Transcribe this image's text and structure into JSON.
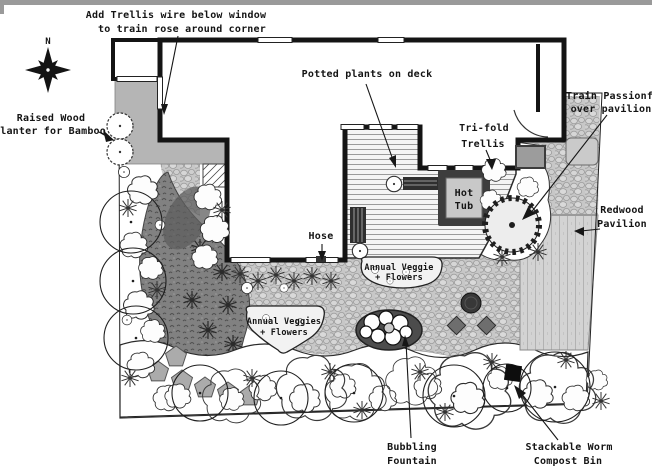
{
  "title": "Backyard landscape design plan",
  "compass": {
    "north": "N"
  },
  "colors": {
    "wall": "#141414",
    "patio_cobble": "#c7c7c7",
    "side_path": "#b5b5b5",
    "lawn_swath": "#818181",
    "pavilion": "#d3d3d3",
    "hot_tub_frame": "#3d3d3d",
    "hot_tub_inner": "#c8c8c8",
    "text": "#141414"
  },
  "labels": {
    "add_trellis": {
      "line1": "Add Trellis wire below window",
      "line2": "to train rose around corner"
    },
    "potted_plants": {
      "line1": "Potted plants on deck"
    },
    "train_passionfruit": {
      "line1": "Train Passionfruit",
      "line2": "over pavilion"
    },
    "raised_planter": {
      "line1": "Raised Wood",
      "line2": "Planter for Bamboo"
    },
    "trifold_trellis": {
      "line1": "Tri-fold",
      "line2": "Trellis"
    },
    "hose": {
      "line1": "Hose"
    },
    "hot_tub": {
      "line1": "Hot",
      "line2": "Tub"
    },
    "redwood_pavilion": {
      "line1": "Redwood",
      "line2": "Pavilion"
    },
    "annual_veggie_deck": {
      "line1": "Annual Veggie",
      "line2": "+ Flowers"
    },
    "annual_veggie_patio": {
      "line1": "Annual Veggies",
      "line2": "+ Flowers"
    },
    "bubbling_fountain": {
      "line1": "Bubbling",
      "line2": "Fountain"
    },
    "worm_compost": {
      "line1": "Stackable Worm",
      "line2": "Compost Bin"
    }
  }
}
